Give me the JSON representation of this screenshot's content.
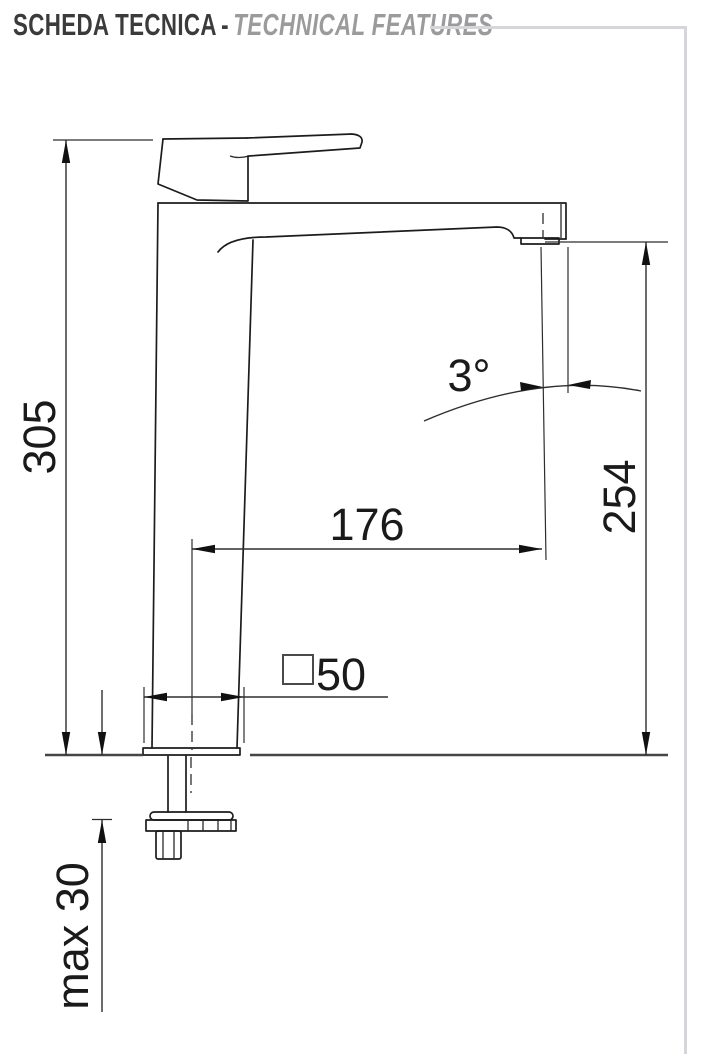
{
  "header": {
    "title_it": "SCHEDA TECNICA",
    "separator": "-",
    "title_en": "TECHNICAL FEATURES"
  },
  "drawing": {
    "type": "technical-dimension-drawing",
    "subject": "tall single-lever basin mixer tap, side elevation",
    "dimensions": {
      "total_height": "305",
      "spout_outlet_height": "254",
      "spout_reach": "176",
      "outlet_angle": "3°",
      "base_square_size": "50",
      "base_square_symbol": "square",
      "max_deck_thickness": "max 30"
    },
    "colors": {
      "object_line": "#1c1c1c",
      "dimension_line": "#2e2e2e",
      "header_rule": "#d4d6d9",
      "title_primary": "#3b3b3b",
      "title_secondary": "#9b9b9b"
    }
  }
}
